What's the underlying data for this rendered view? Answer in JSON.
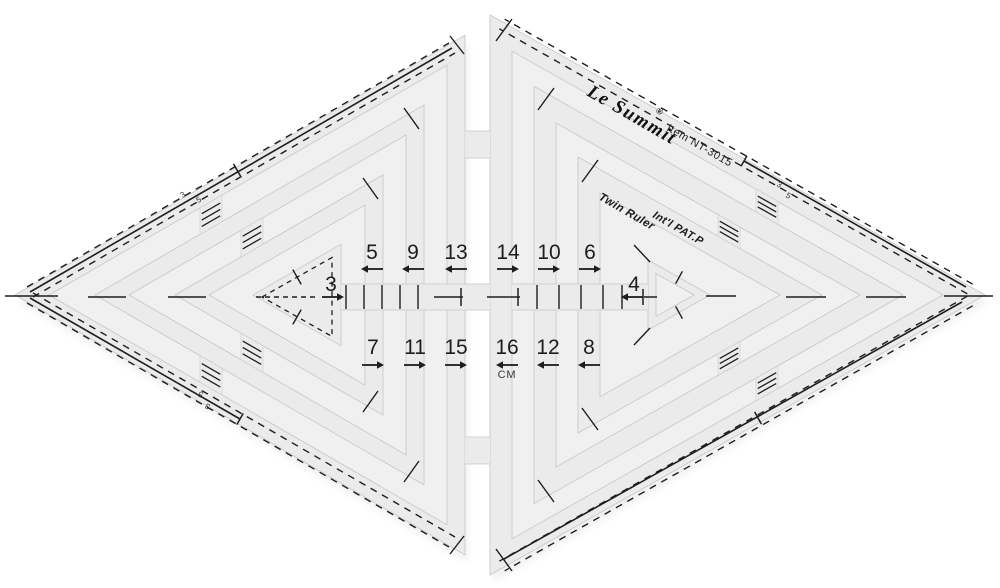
{
  "product": {
    "brand": "Le Summit",
    "registered_mark": "®",
    "item_number": "Item NT-3015",
    "product_name": "Twin Ruler",
    "patent": "Int'l PAT.P",
    "unit": "CM"
  },
  "scales": {
    "top_row": [
      {
        "label": "5",
        "arrow": "left"
      },
      {
        "label": "9",
        "arrow": "left"
      },
      {
        "label": "13",
        "arrow": "left"
      },
      {
        "label": "14",
        "arrow": "right"
      },
      {
        "label": "10",
        "arrow": "right"
      },
      {
        "label": "6",
        "arrow": "right"
      }
    ],
    "bottom_row": [
      {
        "label": "7",
        "arrow": "right"
      },
      {
        "label": "11",
        "arrow": "right"
      },
      {
        "label": "15",
        "arrow": "right"
      },
      {
        "label": "16",
        "arrow": "left"
      },
      {
        "label": "12",
        "arrow": "left"
      },
      {
        "label": "8",
        "arrow": "left"
      }
    ],
    "left_center": {
      "label": "3",
      "arrow": "right"
    },
    "right_center": {
      "label": "4",
      "arrow": "left"
    },
    "edge_marks": [
      "3",
      "5"
    ]
  },
  "colors": {
    "background": "#ffffff",
    "plastic": "#ebebeb",
    "plastic_edge": "#c6c6c8",
    "print": "#1e1e1e"
  }
}
